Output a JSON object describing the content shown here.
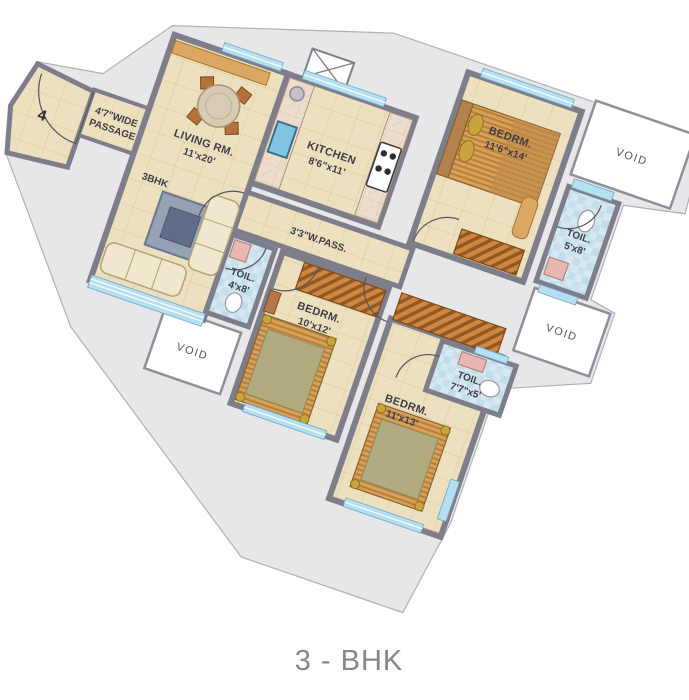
{
  "title": "3 - BHK",
  "unit": {
    "number": "4"
  },
  "labels": {
    "passage_l1": "4'7\"WIDE",
    "passage_l2": "PASSAGE",
    "plan_type": "3BHK",
    "living_name": "LIVING RM.",
    "living_dims": "11'x20'",
    "kitchen_name": "KITCHEN",
    "kitchen_dims": "8'6\"x11'",
    "bedroom1_name": "BEDRM.",
    "bedroom1_dims": "11'6\"x14'",
    "toilet1_name": "TOIL.",
    "toilet1_dims": "5'x8'",
    "wpass": "3'3\"W.PASS.",
    "toilet2_name": "TOIL.",
    "toilet2_dims": "4'x8'",
    "bedroom2_name": "BEDRM.",
    "bedroom2_dims": "10'x12'",
    "toilet3_name": "TOIL.",
    "toilet3_dims": "7'7\"x5'",
    "bedroom3_name": "BEDRM.",
    "bedroom3_dims": "11'x13'",
    "void": "VOID"
  },
  "colors": {
    "wall": "#7d7e8a",
    "floor": "#ece0bf",
    "toilet_tile": "#d5e7f0",
    "window": "#b5e0f2",
    "wardrobe": "#cd8743",
    "silhouette": "#e7e7ea",
    "title_text": "#87878a"
  }
}
